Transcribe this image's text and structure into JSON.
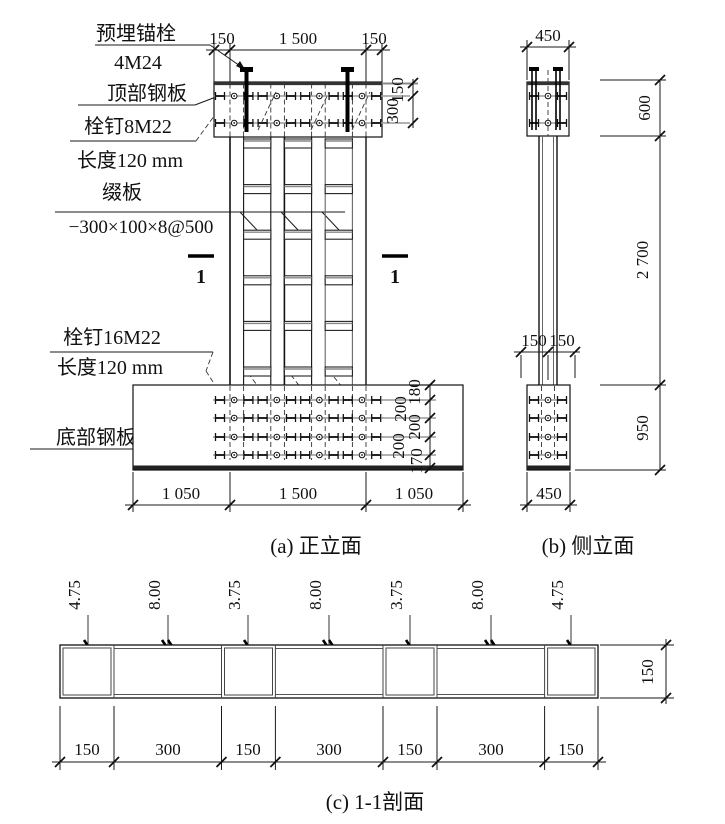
{
  "drawing": {
    "front": {
      "caption": "(a) 正立面",
      "section_mark": "1",
      "labels": {
        "anchor": "预埋锚栓",
        "anchor2": "4M24",
        "top_plate": "顶部钢板",
        "stud_top": "栓钉8M22",
        "stud_top_len": "长度120 mm",
        "batten": "缀板",
        "batten_spec": "−300×100×8@500",
        "stud_bottom": "栓钉16M22",
        "stud_bottom_len": "长度120 mm",
        "bottom_plate": "底部钢板"
      },
      "dim_top": [
        "150",
        "1 500",
        "150"
      ],
      "dim_plate_right": [
        "150",
        "300"
      ],
      "dim_base_right": [
        "180",
        "200",
        "200",
        "200",
        "170"
      ],
      "dim_bottom": [
        "1 050",
        "1 500",
        "1 050"
      ]
    },
    "side": {
      "caption": "(b) 侧立面",
      "dim_top": "450",
      "dim_mid": [
        "150",
        "150"
      ],
      "dim_right": [
        "600",
        "2 700",
        "950"
      ],
      "dim_bottom": "450"
    },
    "section": {
      "caption": "(c) 1-1剖面",
      "thickness": [
        "4.75",
        "8.00",
        "3.75",
        "8.00",
        "3.75",
        "8.00",
        "4.75"
      ],
      "dim_bottom": [
        "150",
        "300",
        "150",
        "300",
        "150",
        "300",
        "150"
      ],
      "dim_right": "150"
    }
  }
}
